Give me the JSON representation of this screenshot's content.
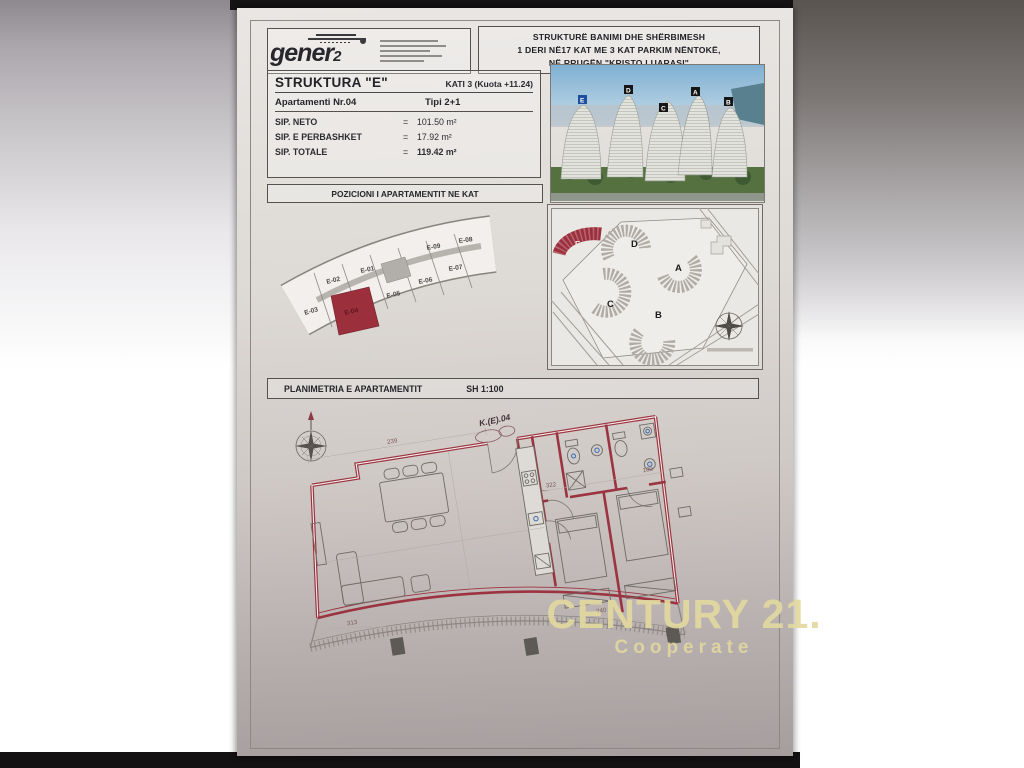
{
  "watermark": {
    "brand": "CENTURY 21.",
    "sub": "Cooperate"
  },
  "header": {
    "logo": {
      "name": "gener",
      "sub": "2"
    },
    "title_line1": "STRUKTURË BANIMI DHE SHËRBIMESH",
    "title_line2": "1 DERI NË17 KAT ME 3 KAT PARKIM NËNTOKË,",
    "title_line3": "NË RRUGËN  \"KRISTO LUARASI\""
  },
  "info": {
    "struktura": "STRUKTURA \"E\"",
    "kati": "KATI 3  (Kuota +11.24)",
    "apartment": "Apartamenti Nr.04",
    "type": "Tipi 2+1",
    "rows": [
      {
        "label": "SIP. NETO",
        "eq": "=",
        "value": "101.50 m²"
      },
      {
        "label": "SIP. E PERBASHKET",
        "eq": "=",
        "value": "17.92 m²"
      },
      {
        "label": "SIP. TOTALE",
        "eq": "=",
        "value": "119.42 m²"
      }
    ]
  },
  "position": {
    "title": "POZICIONI I APARTAMENTIT NE KAT",
    "outer": [
      "E-02",
      "E-01",
      "E-09",
      "E-08"
    ],
    "inner": [
      "E-03",
      "E-04",
      "E-05",
      "E-06",
      "E-07"
    ],
    "highlighted": "E-04"
  },
  "siteplan": {
    "a": "A",
    "b": "B",
    "c": "C",
    "d": "D",
    "e": "E"
  },
  "render": {
    "e": "E",
    "d": "D",
    "c": "C",
    "a": "A",
    "b": "B"
  },
  "plan": {
    "title": "PLANIMETRIA E APARTAMENTIT",
    "scale": "SH 1:100",
    "unit": "K.(E).04",
    "dims": [
      "239",
      "322",
      "100",
      "313",
      "240"
    ]
  },
  "colors": {
    "wall_red": "#9c3340",
    "highlight_red": "#9c2f3c",
    "watermark": "#e2d89e"
  }
}
